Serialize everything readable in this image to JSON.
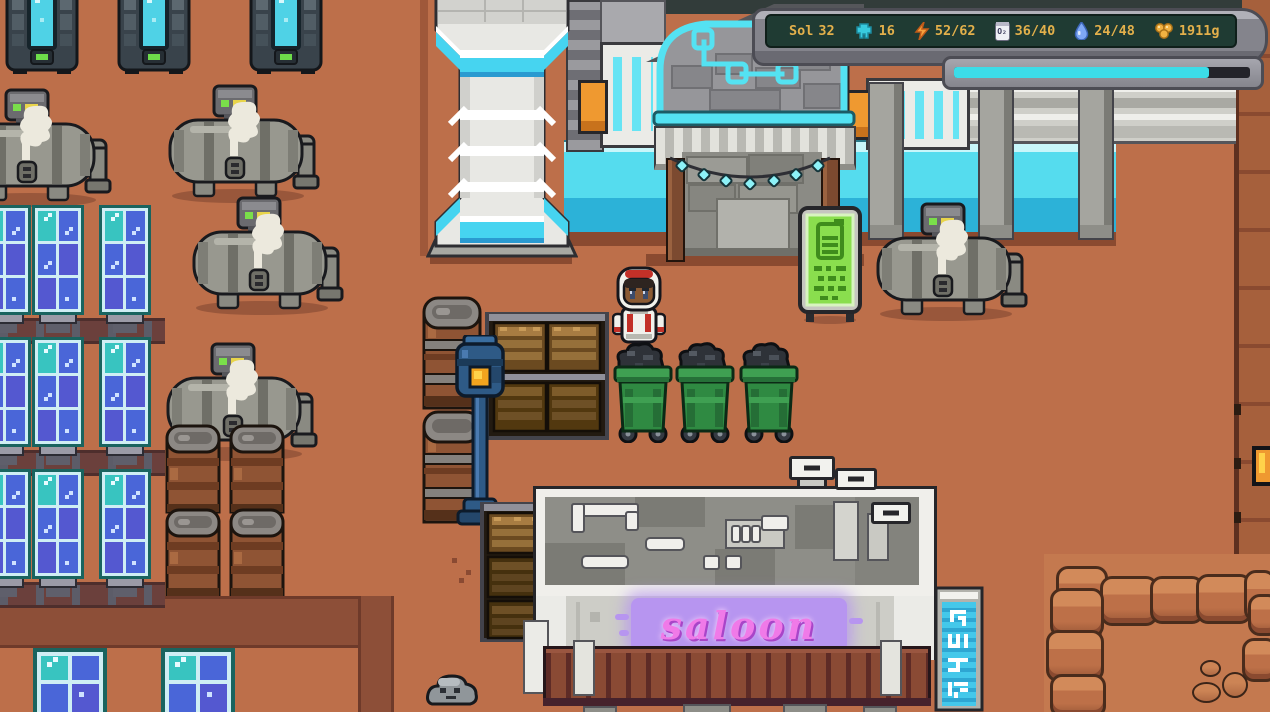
{
  "hud": {
    "sol_label": "Sol",
    "sol_value": "32",
    "stats": {
      "colonists": "16",
      "power": "52/62",
      "oxygen": "36/40",
      "water": "24/48",
      "money": "1911g"
    },
    "oxygen_icon_label": "O₂",
    "progress_pct": 86,
    "colors": {
      "frame": "#84848c",
      "screen": "#1f3b33",
      "text": "#e3b04b",
      "bar_fill": "#3cdce8",
      "colonists_icon": "#38cade",
      "power_icon": "#f6a03c",
      "water_icon": "#7ea8f4",
      "money_icon": "#f2b242"
    },
    "icons": [
      "colonists-icon",
      "power-icon",
      "oxygen-icon",
      "water-icon",
      "money-icon"
    ]
  },
  "signs": {
    "saloon_text": "saloon",
    "battery_sign": "battery-charge-sign",
    "vertical_sign": "neon-glyph-sign"
  },
  "scene": {
    "colors": {
      "ground": "#bd6f4a",
      "road": "#8d4f38",
      "awning": "#8a4a34",
      "neon_text": "#f07ae8",
      "neon_glow": "#b795f0",
      "glass_band": "#55dcee"
    },
    "entities": [
      {
        "type": "condenser",
        "x": 5,
        "y": -16
      },
      {
        "type": "condenser",
        "x": 117,
        "y": -16
      },
      {
        "type": "condenser",
        "x": 249,
        "y": -16
      },
      {
        "type": "tank",
        "x": -40,
        "y": 88
      },
      {
        "type": "tank",
        "x": 168,
        "y": 84
      },
      {
        "type": "tank",
        "x": 192,
        "y": 196
      },
      {
        "type": "tank",
        "x": 166,
        "y": 342
      },
      {
        "type": "tank",
        "x": 876,
        "y": 202
      },
      {
        "type": "solar-strip",
        "x": 0,
        "y": 318
      },
      {
        "type": "solar-strip",
        "x": 0,
        "y": 450
      },
      {
        "type": "solar-strip",
        "x": 0,
        "y": 582
      },
      {
        "type": "solar",
        "x": -21,
        "y": 205
      },
      {
        "type": "solar",
        "x": 32,
        "y": 205
      },
      {
        "type": "solar",
        "x": 99,
        "y": 205
      },
      {
        "type": "solar",
        "x": -21,
        "y": 337
      },
      {
        "type": "solar",
        "x": 32,
        "y": 337
      },
      {
        "type": "solar",
        "x": 99,
        "y": 337
      },
      {
        "type": "solar",
        "x": -21,
        "y": 469
      },
      {
        "type": "solar",
        "x": 32,
        "y": 469
      },
      {
        "type": "solar",
        "x": 99,
        "y": 469
      },
      {
        "type": "solar-small",
        "x": 33,
        "y": 648
      },
      {
        "type": "solar-small",
        "x": 161,
        "y": 648
      },
      {
        "type": "barrels",
        "x": 164,
        "y": 424
      },
      {
        "type": "barrels",
        "x": 228,
        "y": 424
      },
      {
        "type": "barrel-tall",
        "x": 420,
        "y": 296
      },
      {
        "type": "lamp",
        "x": 450,
        "y": 335
      },
      {
        "type": "crate-shelf",
        "x": 485,
        "y": 312
      },
      {
        "type": "crate-stack",
        "x": 480,
        "y": 502
      },
      {
        "type": "character",
        "x": 612,
        "y": 266
      },
      {
        "type": "bin",
        "x": 613,
        "y": 339
      },
      {
        "type": "bin",
        "x": 675,
        "y": 339
      },
      {
        "type": "bin",
        "x": 739,
        "y": 339
      },
      {
        "type": "battery-sign",
        "x": 798,
        "y": 206
      },
      {
        "type": "rock",
        "x": 424,
        "y": 670
      }
    ]
  }
}
